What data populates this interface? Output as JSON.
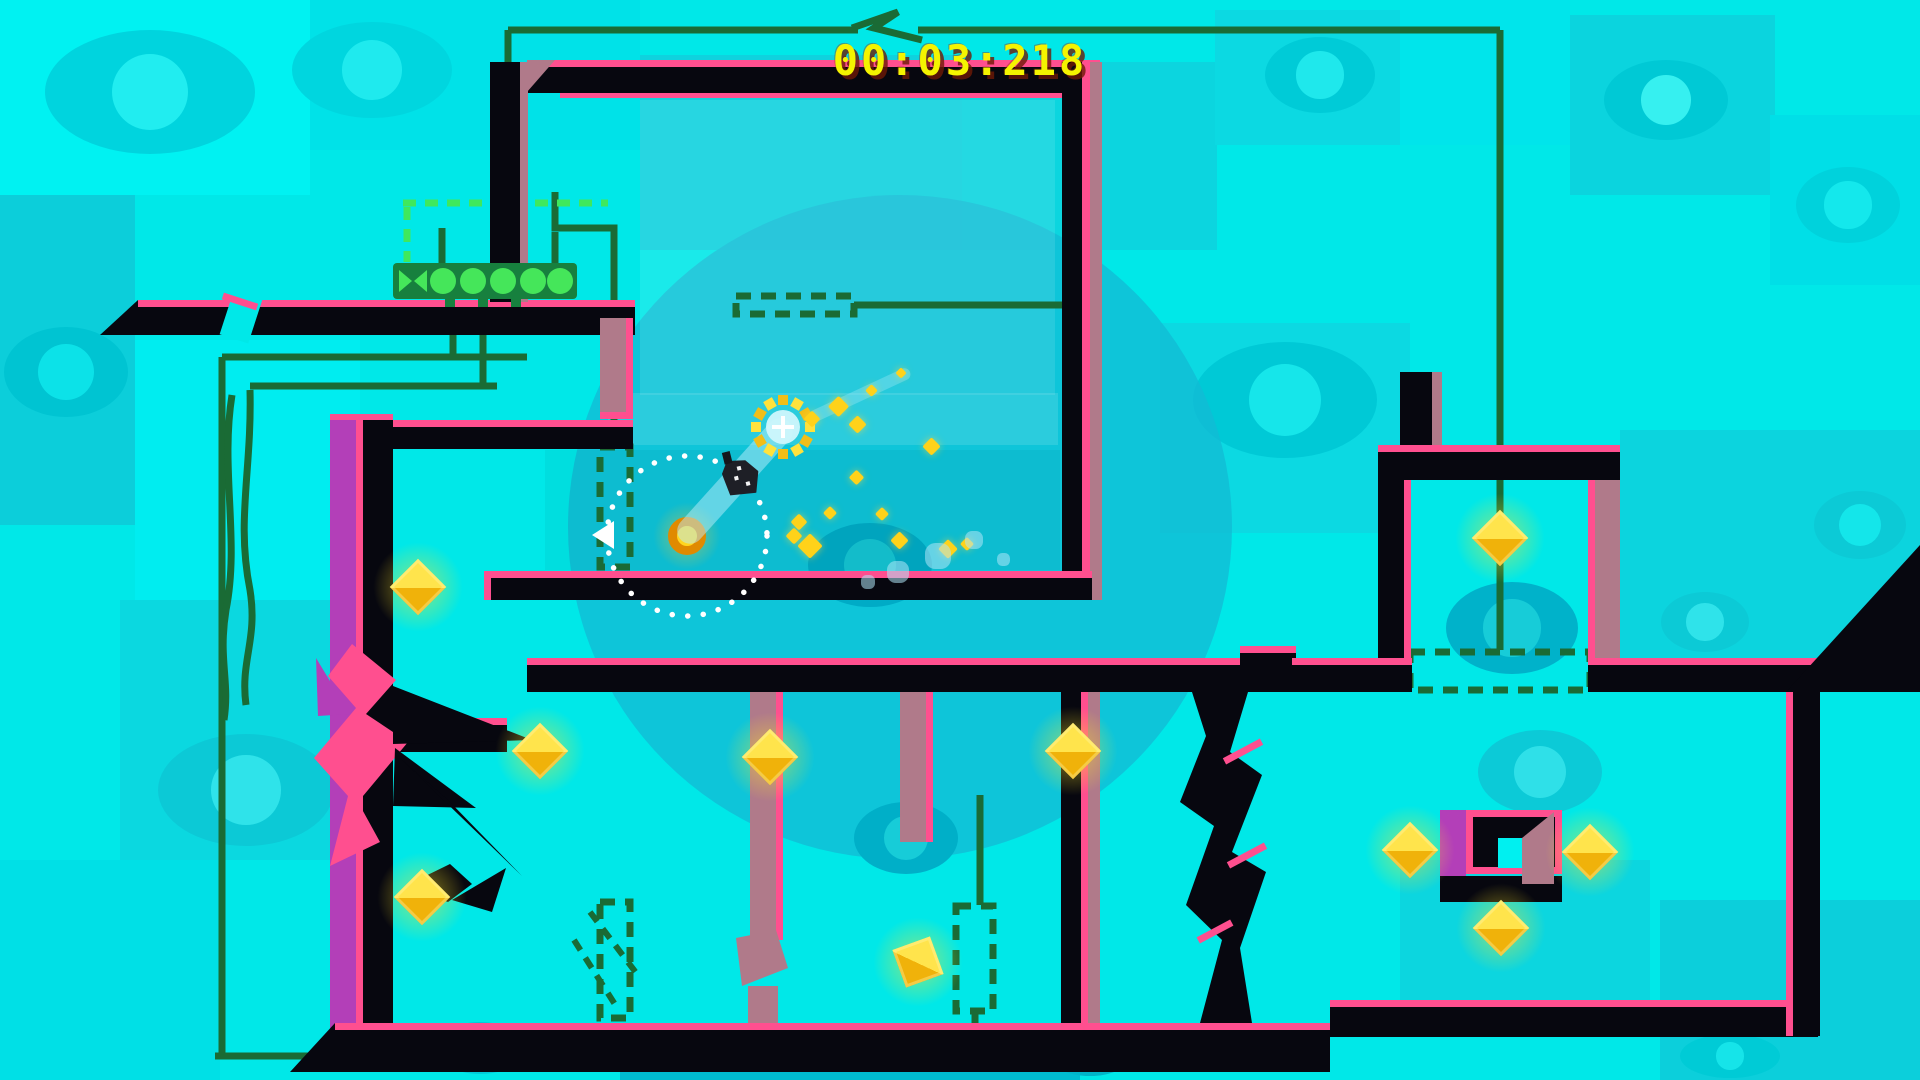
{
  "hud": {
    "timer": "00:03:218"
  },
  "palette": {
    "base": "#00E8E8",
    "pink": "#FF4F8F",
    "black": "#07070F",
    "mauve": "#B07A8A",
    "purple": "#B33FB8",
    "wire": "#1A6B35",
    "bright_green": "#3FE85C",
    "bar_green": "#17803E",
    "button_green": "#45E65A",
    "circle_teal": "#12BCD4",
    "diamond_hi": "#FFE44C",
    "diamond_lo": "#F0B20A",
    "timer_yellow": "#F4F400",
    "coin_ring": "#E08A00",
    "coin_core": "#FFD51F"
  },
  "scene": {
    "w": 1920,
    "h": 1080,
    "tiles": [
      {
        "x": 0,
        "y": 0,
        "w": 310,
        "h": 195,
        "c": "#00F2F2"
      },
      {
        "x": 310,
        "y": 0,
        "w": 330,
        "h": 150,
        "c": "#00E2E8"
      },
      {
        "x": 640,
        "y": 55,
        "w": 330,
        "h": 195,
        "c": "#0FD2DE"
      },
      {
        "x": 962,
        "y": 62,
        "w": 255,
        "h": 188,
        "c": "#0CD5DF"
      },
      {
        "x": 1215,
        "y": 10,
        "w": 185,
        "h": 135,
        "c": "#0CD9E2"
      },
      {
        "x": 1400,
        "y": 0,
        "w": 170,
        "h": 145,
        "c": "#00E5EB"
      },
      {
        "x": 1570,
        "y": 15,
        "w": 205,
        "h": 180,
        "c": "#0BD4DE"
      },
      {
        "x": 1770,
        "y": 115,
        "w": 150,
        "h": 170,
        "c": "#00DFE7"
      },
      {
        "x": 0,
        "y": 195,
        "w": 135,
        "h": 330,
        "c": "#0CCEDA"
      },
      {
        "x": 135,
        "y": 340,
        "w": 225,
        "h": 260,
        "c": "#00EDF0"
      },
      {
        "x": 1160,
        "y": 323,
        "w": 250,
        "h": 210,
        "c": "#0CD9E2"
      },
      {
        "x": 1620,
        "y": 430,
        "w": 300,
        "h": 240,
        "c": "#0CD4DE"
      },
      {
        "x": 120,
        "y": 600,
        "w": 240,
        "h": 260,
        "c": "#0BD8E0"
      },
      {
        "x": 1400,
        "y": 860,
        "w": 250,
        "h": 160,
        "c": "#0CD6DF"
      },
      {
        "x": 620,
        "y": 1042,
        "w": 460,
        "h": 38,
        "c": "#00BCD0"
      },
      {
        "x": 0,
        "y": 860,
        "w": 220,
        "h": 220,
        "c": "#00E0E6"
      },
      {
        "x": 1660,
        "y": 900,
        "w": 260,
        "h": 180,
        "c": "#0CCFDB"
      }
    ],
    "big_circle": {
      "cx": 900,
      "cy": 527,
      "r": 332,
      "c": "#12BCD4",
      "o": 0.8
    },
    "eyes": [
      {
        "cx": 150,
        "cy": 92,
        "rx": 105,
        "ry": 62,
        "body": "#00D4DE",
        "iris": "#21EDF0",
        "in": false
      },
      {
        "cx": 372,
        "cy": 70,
        "rx": 80,
        "ry": 48,
        "body": "#00D6DF",
        "iris": "#1FEAEE",
        "in": false
      },
      {
        "cx": 1285,
        "cy": 400,
        "rx": 92,
        "ry": 58,
        "body": "#00C9D6",
        "iris": "#16E6EA",
        "in": false
      },
      {
        "cx": 1320,
        "cy": 75,
        "rx": 55,
        "ry": 38,
        "body": "#00CBD7",
        "iris": "#1FE8EC",
        "in": false
      },
      {
        "cx": 1666,
        "cy": 100,
        "rx": 62,
        "ry": 40,
        "body": "#00C9D5",
        "iris": "#36F0F0",
        "in": false
      },
      {
        "cx": 1848,
        "cy": 205,
        "rx": 52,
        "ry": 38,
        "body": "#00D2DC",
        "iris": "#14E8EC",
        "in": false
      },
      {
        "cx": 66,
        "cy": 372,
        "rx": 62,
        "ry": 45,
        "body": "#00C4D2",
        "iris": "#0CE2E8",
        "in": false
      },
      {
        "cx": 246,
        "cy": 790,
        "rx": 88,
        "ry": 56,
        "body": "#0CC9D6",
        "iris": "#2FE3EA",
        "in": false
      },
      {
        "cx": 1540,
        "cy": 772,
        "rx": 62,
        "ry": 42,
        "body": "#0CCAD7",
        "iris": "#2FE0E8",
        "in": false
      },
      {
        "cx": 1705,
        "cy": 622,
        "rx": 44,
        "ry": 30,
        "body": "#0CCAD6",
        "iris": "#2FE3EA",
        "in": false
      },
      {
        "cx": 1860,
        "cy": 525,
        "rx": 46,
        "ry": 34,
        "body": "#0CCAD6",
        "iris": "#14E6EA",
        "in": false
      },
      {
        "cx": 480,
        "cy": 1048,
        "rx": 46,
        "ry": 26,
        "body": "#00CBD8",
        "iris": "#16E4E9",
        "in": false
      },
      {
        "cx": 1090,
        "cy": 1054,
        "rx": 42,
        "ry": 22,
        "body": "#00B5C9",
        "iris": "#12CED9",
        "in": false
      },
      {
        "cx": 1730,
        "cy": 1056,
        "rx": 50,
        "ry": 22,
        "body": "#00CBD6",
        "iris": "#16E4E9",
        "in": false
      },
      {
        "cx": 906,
        "cy": 838,
        "rx": 52,
        "ry": 36,
        "body": "#00AFC8",
        "iris": "#17CCD8",
        "in": true
      },
      {
        "cx": 1512,
        "cy": 628,
        "rx": 66,
        "ry": 46,
        "body": "#00B2CA",
        "iris": "#17CCD8",
        "in": true
      },
      {
        "cx": 870,
        "cy": 565,
        "rx": 62,
        "ry": 42,
        "body": "#00ABC6",
        "iris": "#15C5D2",
        "in": true
      }
    ],
    "panels": [
      {
        "x": 640,
        "y": 100,
        "w": 415,
        "h": 295,
        "c": "rgba(255,255,255,0.10)"
      },
      {
        "x": 608,
        "y": 393,
        "w": 450,
        "h": 52,
        "c": "rgba(255,255,255,0.12)"
      },
      {
        "x": 545,
        "y": 450,
        "w": 515,
        "h": 120,
        "c": "rgba(0,40,60,0.05)"
      }
    ],
    "wires": [
      "M508,30 H858",
      "M918,30 H1500",
      "M1500,30 V650",
      "M508,30 V203",
      "M852,28 L898,12 L874,28 L922,40",
      "M555,192 V228 H614 V445",
      "M442,263 V228",
      "M555,263 V232",
      "M453,335 V357",
      "M483,335 V386",
      "M222,357 H527",
      "M250,386 H497",
      "M222,357 V1056",
      "M250,390 C252,470 236,520 250,590 C258,640 240,660 246,705",
      "M232,395 C220,470 240,540 226,610 C218,660 230,680 224,720",
      "M215,1056 H975",
      "M975,1056 V1012",
      "M980,795 V905",
      "M854,305 H1062"
    ],
    "bright_dashes": [
      "M403,203 H608",
      "M407,207 V262"
    ],
    "gates": [
      {
        "x": 600,
        "y": 447,
        "w": 30,
        "h": 120
      },
      {
        "x": 600,
        "y": 902,
        "w": 30,
        "h": 116
      },
      {
        "x": 956,
        "y": 906,
        "w": 37,
        "h": 105
      },
      {
        "x": 1410,
        "y": 652,
        "w": 180,
        "h": 38
      },
      {
        "x": 736,
        "y": 296,
        "w": 118,
        "h": 18
      }
    ],
    "crack_dashes": [
      "M590,912 L640,978",
      "M574,940 L616,1006"
    ],
    "rects": [
      {
        "x": 560,
        "y": 92,
        "w": 502,
        "h": 6,
        "k": "pink"
      },
      {
        "x": 138,
        "y": 300,
        "w": 497,
        "h": 7,
        "k": "pink"
      },
      {
        "x": 138,
        "y": 307,
        "w": 497,
        "h": 28,
        "k": "black"
      },
      {
        "x": 527,
        "y": 60,
        "w": 573,
        "h": 7,
        "k": "pink"
      },
      {
        "x": 527,
        "y": 67,
        "w": 573,
        "h": 26,
        "k": "black"
      },
      {
        "x": 490,
        "y": 62,
        "w": 30,
        "h": 240,
        "k": "black"
      },
      {
        "x": 520,
        "y": 62,
        "w": 8,
        "h": 240,
        "k": "mauve"
      },
      {
        "x": 1062,
        "y": 62,
        "w": 20,
        "h": 538,
        "k": "black"
      },
      {
        "x": 1082,
        "y": 62,
        "w": 8,
        "h": 538,
        "k": "pink"
      },
      {
        "x": 1090,
        "y": 62,
        "w": 12,
        "h": 538,
        "k": "mauve"
      },
      {
        "x": 393,
        "y": 420,
        "w": 240,
        "h": 7,
        "k": "pink"
      },
      {
        "x": 393,
        "y": 427,
        "w": 240,
        "h": 22,
        "k": "black"
      },
      {
        "x": 330,
        "y": 414,
        "w": 63,
        "h": 6,
        "k": "pink"
      },
      {
        "x": 330,
        "y": 420,
        "w": 26,
        "h": 616,
        "k": "purple"
      },
      {
        "x": 356,
        "y": 420,
        "w": 7,
        "h": 616,
        "k": "pink"
      },
      {
        "x": 363,
        "y": 420,
        "w": 30,
        "h": 616,
        "k": "black"
      },
      {
        "x": 600,
        "y": 318,
        "w": 26,
        "h": 100,
        "k": "mauve"
      },
      {
        "x": 626,
        "y": 318,
        "w": 7,
        "h": 100,
        "k": "pink"
      },
      {
        "x": 600,
        "y": 412,
        "w": 33,
        "h": 7,
        "k": "pink"
      },
      {
        "x": 484,
        "y": 571,
        "w": 608,
        "h": 7,
        "k": "pink"
      },
      {
        "x": 484,
        "y": 571,
        "w": 7,
        "h": 29,
        "k": "pink"
      },
      {
        "x": 491,
        "y": 578,
        "w": 601,
        "h": 22,
        "k": "black"
      },
      {
        "x": 393,
        "y": 718,
        "w": 114,
        "h": 7,
        "k": "pink"
      },
      {
        "x": 393,
        "y": 725,
        "w": 114,
        "h": 27,
        "k": "black"
      },
      {
        "x": 527,
        "y": 658,
        "w": 7,
        "h": 34,
        "k": "pink"
      },
      {
        "x": 527,
        "y": 658,
        "w": 716,
        "h": 7,
        "k": "pink"
      },
      {
        "x": 527,
        "y": 665,
        "w": 716,
        "h": 27,
        "k": "black"
      },
      {
        "x": 1240,
        "y": 646,
        "w": 56,
        "h": 7,
        "k": "pink"
      },
      {
        "x": 1240,
        "y": 653,
        "w": 56,
        "h": 39,
        "k": "black"
      },
      {
        "x": 1292,
        "y": 658,
        "w": 120,
        "h": 7,
        "k": "pink"
      },
      {
        "x": 1292,
        "y": 665,
        "w": 120,
        "h": 27,
        "k": "black"
      },
      {
        "x": 1588,
        "y": 658,
        "w": 230,
        "h": 7,
        "k": "pink"
      },
      {
        "x": 1588,
        "y": 665,
        "w": 230,
        "h": 27,
        "k": "black"
      },
      {
        "x": 750,
        "y": 692,
        "w": 26,
        "h": 248,
        "k": "mauve"
      },
      {
        "x": 776,
        "y": 692,
        "w": 7,
        "h": 248,
        "k": "pink"
      },
      {
        "x": 748,
        "y": 986,
        "w": 30,
        "h": 38,
        "k": "mauve"
      },
      {
        "x": 900,
        "y": 692,
        "w": 26,
        "h": 150,
        "k": "mauve"
      },
      {
        "x": 926,
        "y": 692,
        "w": 7,
        "h": 150,
        "k": "pink"
      },
      {
        "x": 1061,
        "y": 692,
        "w": 20,
        "h": 344,
        "k": "black"
      },
      {
        "x": 1081,
        "y": 692,
        "w": 7,
        "h": 344,
        "k": "pink"
      },
      {
        "x": 1088,
        "y": 692,
        "w": 12,
        "h": 344,
        "k": "mauve"
      },
      {
        "x": 335,
        "y": 1023,
        "w": 995,
        "h": 7,
        "k": "pink"
      },
      {
        "x": 335,
        "y": 1030,
        "w": 995,
        "h": 42,
        "k": "black"
      },
      {
        "x": 1330,
        "y": 1000,
        "w": 488,
        "h": 7,
        "k": "pink"
      },
      {
        "x": 1330,
        "y": 1007,
        "w": 488,
        "h": 30,
        "k": "black"
      },
      {
        "x": 1786,
        "y": 692,
        "w": 7,
        "h": 344,
        "k": "pink"
      },
      {
        "x": 1793,
        "y": 692,
        "w": 27,
        "h": 344,
        "k": "black"
      },
      {
        "x": 1400,
        "y": 372,
        "w": 40,
        "h": 80,
        "k": "black"
      },
      {
        "x": 1432,
        "y": 372,
        "w": 10,
        "h": 80,
        "k": "mauve"
      },
      {
        "x": 1378,
        "y": 445,
        "w": 242,
        "h": 7,
        "k": "pink"
      },
      {
        "x": 1378,
        "y": 452,
        "w": 242,
        "h": 28,
        "k": "black"
      },
      {
        "x": 1378,
        "y": 480,
        "w": 26,
        "h": 178,
        "k": "black"
      },
      {
        "x": 1404,
        "y": 480,
        "w": 7,
        "h": 178,
        "k": "pink"
      },
      {
        "x": 1588,
        "y": 480,
        "w": 7,
        "h": 178,
        "k": "pink"
      },
      {
        "x": 1595,
        "y": 480,
        "w": 25,
        "h": 178,
        "k": "mauve"
      },
      {
        "x": 1440,
        "y": 810,
        "w": 26,
        "h": 66,
        "k": "purple"
      },
      {
        "x": 1466,
        "y": 810,
        "w": 96,
        "h": 64,
        "k": "pink"
      },
      {
        "x": 1473,
        "y": 817,
        "w": 82,
        "h": 50,
        "k": "black"
      },
      {
        "x": 1498,
        "y": 838,
        "w": 32,
        "h": 30,
        "k": "window"
      },
      {
        "x": 1440,
        "y": 876,
        "w": 122,
        "h": 26,
        "k": "black"
      }
    ],
    "crack_overlay": [
      {
        "x": 226,
        "y": 294,
        "w": 30,
        "h": 46,
        "k": "base",
        "rot": 18
      },
      {
        "x": 222,
        "y": 298,
        "w": 36,
        "h": 7,
        "k": "pink",
        "rot": 18
      }
    ],
    "polys": [
      {
        "p": "138,300 100,335 138,335",
        "k": "black"
      },
      {
        "p": "335,1023 335,1072 290,1072",
        "k": "black"
      },
      {
        "p": "1786,692 1920,545 1920,692",
        "k": "black"
      },
      {
        "p": "527,60 555,60 527,92",
        "k": "mauve"
      },
      {
        "p": "352,644 396,680 366,714 408,742 358,802 380,842 330,866 348,796 314,758 356,708 328,676",
        "k": "pink"
      },
      {
        "p": "316,658 350,714 318,716",
        "k": "purple"
      },
      {
        "p": "393,686 532,740 393,744",
        "k": "black"
      },
      {
        "p": "395,748 476,808 393,806",
        "k": "black"
      },
      {
        "p": "400,758 522,876 448,800",
        "k": "black"
      },
      {
        "p": "1192,692 1248,692 1230,752 1262,775 1232,852 1266,872 1240,948 1252,1023 1200,1023 1222,940 1186,905 1214,826 1180,802 1206,736",
        "k": "black"
      },
      {
        "p": "405,886 450,864 472,884 448,902",
        "k": "black"
      },
      {
        "p": "452,900 506,868 492,912",
        "k": "black"
      },
      {
        "p": "736,938 776,930 788,968 742,986",
        "k": "mauve"
      },
      {
        "p": "1522,838 1554,812 1554,884 1522,884",
        "k": "mauve"
      }
    ],
    "pink_accents": [
      {
        "x": 1222,
        "y": 748,
        "w": 42,
        "h": 7,
        "rot": -28
      },
      {
        "x": 1226,
        "y": 852,
        "w": 42,
        "h": 7,
        "rot": -28
      },
      {
        "x": 1196,
        "y": 928,
        "w": 38,
        "h": 7,
        "rot": -28
      }
    ],
    "button_bar": {
      "x": 393,
      "y": 263,
      "w": 184,
      "h": 36,
      "x_slot": {
        "cx": 413,
        "cy": 281
      },
      "circles": [
        {
          "cx": 443
        },
        {
          "cx": 473
        },
        {
          "cx": 503
        },
        {
          "cx": 533
        },
        {
          "cx": 560
        }
      ],
      "r": 13,
      "feet": [
        {
          "x": 445
        },
        {
          "x": 478
        },
        {
          "x": 511
        }
      ]
    },
    "diamonds": [
      {
        "cx": 418,
        "cy": 587,
        "s": 40,
        "rot": 45
      },
      {
        "cx": 540,
        "cy": 751,
        "s": 40,
        "rot": 45
      },
      {
        "cx": 770,
        "cy": 757,
        "s": 40,
        "rot": 45
      },
      {
        "cx": 1073,
        "cy": 751,
        "s": 40,
        "rot": 45
      },
      {
        "cx": 422,
        "cy": 897,
        "s": 40,
        "rot": 45
      },
      {
        "cx": 918,
        "cy": 962,
        "s": 40,
        "rot": 70
      },
      {
        "cx": 1410,
        "cy": 850,
        "s": 40,
        "rot": 45
      },
      {
        "cx": 1590,
        "cy": 852,
        "s": 40,
        "rot": 45
      },
      {
        "cx": 1501,
        "cy": 928,
        "s": 40,
        "rot": 45
      },
      {
        "cx": 1500,
        "cy": 538,
        "s": 40,
        "rot": 45
      }
    ],
    "coin": {
      "cx": 687,
      "cy": 536,
      "d": 38
    },
    "dotted_circle": {
      "cx": 687,
      "cy": 536,
      "r": 80
    },
    "burst": {
      "cx": 783,
      "cy": 427,
      "ring_r": 27,
      "n": 12,
      "sq": 10
    },
    "beams": [
      {
        "cx": 735,
        "cy": 481,
        "w": 160,
        "h": 26,
        "rot": -48,
        "o": 0.5
      },
      {
        "cx": 860,
        "cy": 395,
        "w": 110,
        "h": 12,
        "rot": -25,
        "o": 0.3
      }
    ],
    "player": {
      "x": 720,
      "y": 453,
      "w": 42,
      "h": 46,
      "rot": -14
    },
    "particles": [
      {
        "x": 838,
        "y": 406,
        "s": 15
      },
      {
        "x": 812,
        "y": 419,
        "s": 12
      },
      {
        "x": 857,
        "y": 424,
        "s": 13
      },
      {
        "x": 931,
        "y": 446,
        "s": 13
      },
      {
        "x": 856,
        "y": 477,
        "s": 11
      },
      {
        "x": 830,
        "y": 513,
        "s": 10
      },
      {
        "x": 799,
        "y": 522,
        "s": 12
      },
      {
        "x": 810,
        "y": 546,
        "s": 18
      },
      {
        "x": 794,
        "y": 536,
        "s": 12
      },
      {
        "x": 882,
        "y": 514,
        "s": 10
      },
      {
        "x": 899,
        "y": 540,
        "s": 13
      },
      {
        "x": 948,
        "y": 549,
        "s": 14
      },
      {
        "x": 967,
        "y": 544,
        "s": 10
      },
      {
        "x": 871,
        "y": 390,
        "s": 9
      },
      {
        "x": 901,
        "y": 373,
        "s": 8
      }
    ],
    "splotches": [
      {
        "x": 938,
        "y": 556,
        "s": 26
      },
      {
        "x": 974,
        "y": 540,
        "s": 18
      },
      {
        "x": 1003,
        "y": 559,
        "s": 13
      },
      {
        "x": 898,
        "y": 572,
        "s": 22
      },
      {
        "x": 868,
        "y": 582,
        "s": 14
      }
    ],
    "arrow": {
      "x": 592,
      "y": 521
    }
  }
}
